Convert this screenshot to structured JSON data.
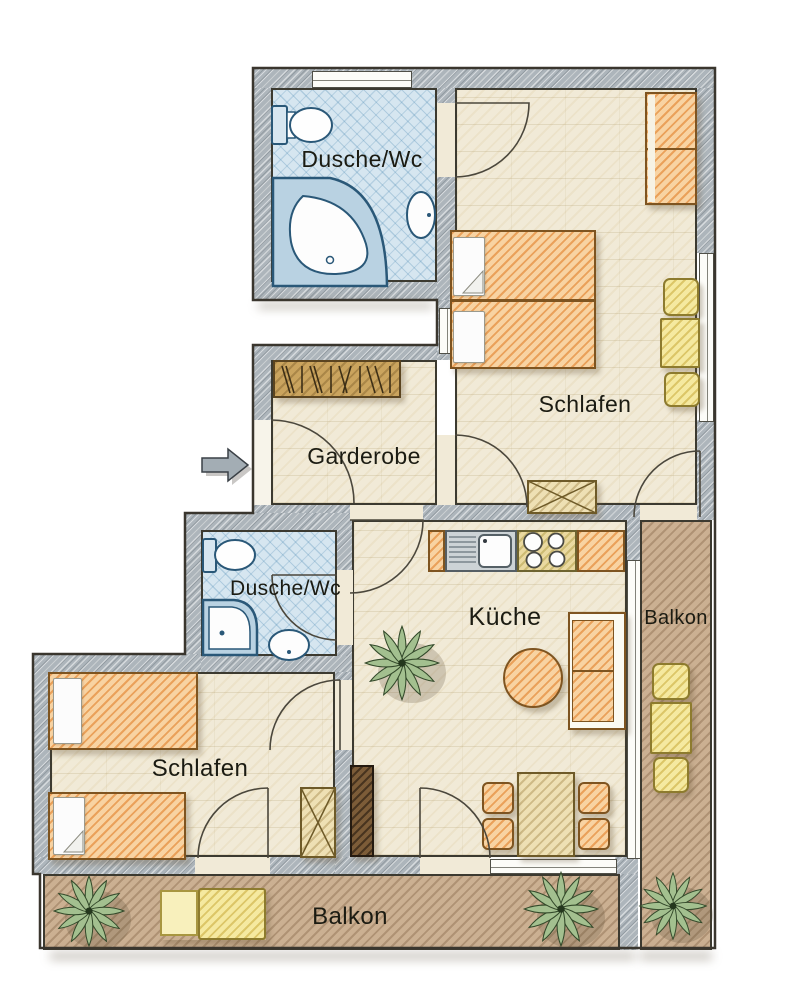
{
  "plan": {
    "rooms": {
      "bath_top": {
        "label": "Dusche/Wc"
      },
      "bedroom_top": {
        "label": "Schlafen"
      },
      "garderobe": {
        "label": "Garderobe"
      },
      "bath_mid": {
        "label": "Dusche/Wc"
      },
      "kitchen": {
        "label": "Küche"
      },
      "balcony_right": {
        "label": "Balkon"
      },
      "bedroom_bottom": {
        "label": "Schlafen"
      },
      "balcony_bottom": {
        "label": "Balkon"
      }
    },
    "colors": {
      "wall_gray": "#adb5bb",
      "floor_beige": "#f1ead7",
      "tile_blue": "#d6e6f0",
      "balcony_brown": "#cbb092",
      "furniture_orange": "#e8973f",
      "furniture_yellow": "#e3cf6e",
      "fixture_blue": "#2a5878",
      "plant_green": "#a3c08f"
    },
    "icons": [
      "entrance-arrow-icon",
      "toilet-icon",
      "bathtub-icon",
      "shower-icon",
      "sink-icon",
      "kitchen-sink-icon",
      "stove-icon",
      "coat-rack-icon",
      "double-bed-icon",
      "single-bed-icon",
      "wardrobe-icon",
      "dresser-icon",
      "chair-icon",
      "table-icon",
      "sofa-icon",
      "round-table-icon",
      "dining-table-icon",
      "lounger-icon",
      "plant-icon",
      "door-swing-icon",
      "window-icon"
    ]
  }
}
